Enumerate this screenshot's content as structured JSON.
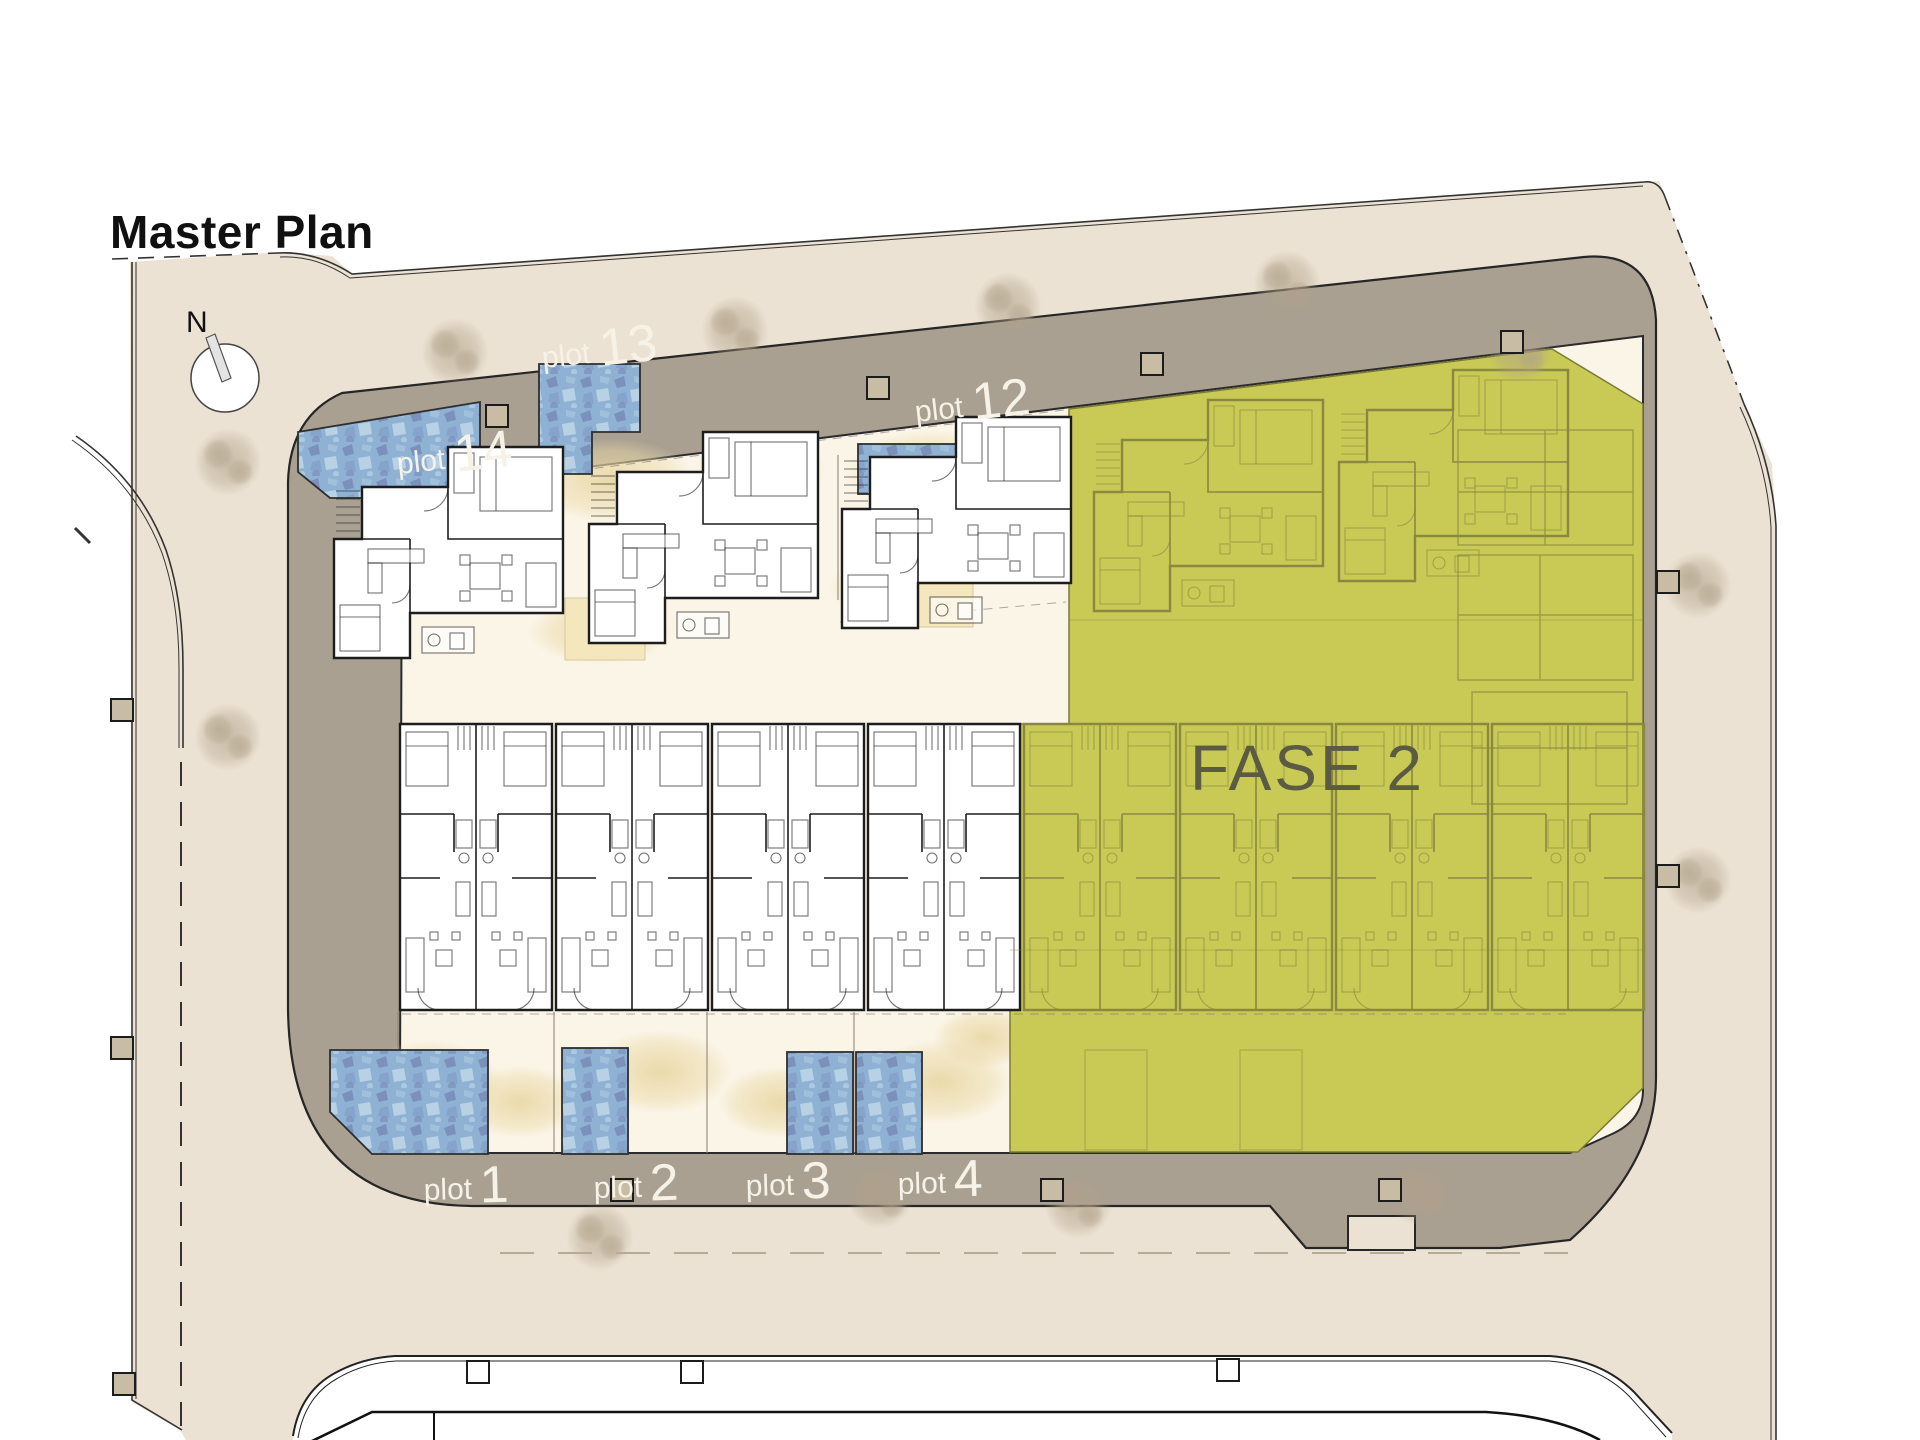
{
  "title": "Master Plan",
  "compass": {
    "north_label": "N"
  },
  "phase_overlay": {
    "label": "FASE 2"
  },
  "plots": {
    "top": [
      {
        "prefix": "plot",
        "number": "14"
      },
      {
        "prefix": "plot",
        "number": "13"
      },
      {
        "prefix": "plot",
        "number": "12"
      }
    ],
    "bottom": [
      {
        "prefix": "plot",
        "number": "1"
      },
      {
        "prefix": "plot",
        "number": "2"
      },
      {
        "prefix": "plot",
        "number": "3"
      },
      {
        "prefix": "plot",
        "number": "4"
      }
    ]
  },
  "colors": {
    "site_beige": "#ece2d3",
    "road_taupe": "#a9a092",
    "inner_ground": "#fbf5e8",
    "phase_fill": "#c9ca55",
    "phase_text": "#5b5a42",
    "pool_blue": "#8fb2d4",
    "sand": "#e7d5a0",
    "label_white": "#f6f2e8",
    "plan_line_dark": "#1d1d1d",
    "plan_line_olive": "#8a8840"
  }
}
